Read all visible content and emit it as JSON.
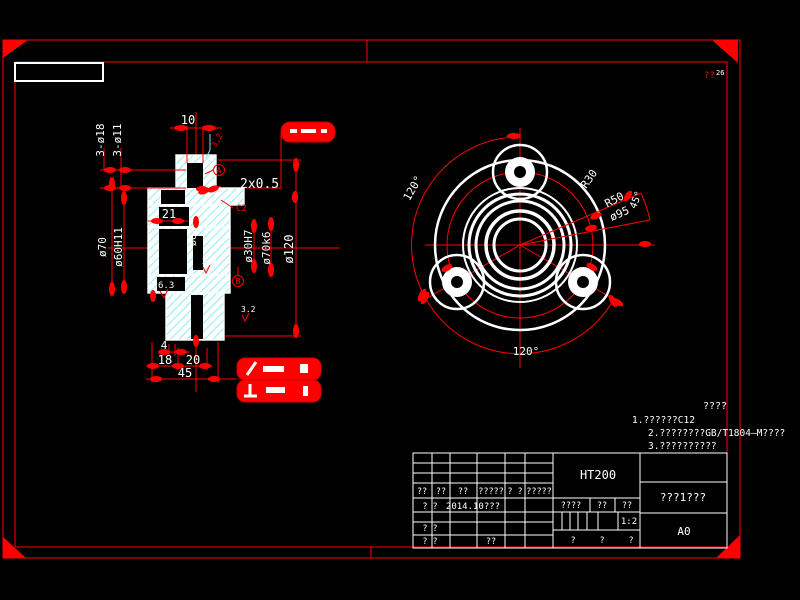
{
  "colors": {
    "bg": "#000000",
    "line": "#ffffff",
    "dim": "#ff0000",
    "hatch": "#7fe8e8"
  },
  "front_view": {
    "dims": {
      "d10": "10",
      "holes18": "3-ø18",
      "holes11": "3-ø11",
      "groove": "2x0.5",
      "c2": "C2",
      "d21": "21",
      "d70": "ø70",
      "d60": "ø60H11",
      "d62": "ø62",
      "d30": "ø30H7",
      "d70k6": "ø70k6",
      "d120": "ø120",
      "l4": "4",
      "l18": "18",
      "l20": "20",
      "l45": "45",
      "finish_top": "3.2",
      "finish_mid": "3.2",
      "finish_low": "3.2",
      "finish_63": "6.3",
      "datumA": "A",
      "datumB": "B"
    }
  },
  "side_view": {
    "dims": {
      "a120top": "120°",
      "a120bot": "120°",
      "r30": "R30",
      "r50": "R50",
      "d95": "ø95",
      "a45": "45°"
    }
  },
  "notes": {
    "title": "????",
    "item1": "1.??????C12",
    "item2": "2.????????GB/T1804—M????",
    "item3": "3.??????????"
  },
  "corner_note": {
    "left": "??",
    "right": "26"
  },
  "title_block": {
    "material": "HT200",
    "part_name": "???1???",
    "sheet_size": "A0",
    "scale": "1:2",
    "col_headers": {
      "c1": "??",
      "c2": "??",
      "c3": "??",
      "c4": "?????",
      "c5": "? ?",
      "c6": "?????"
    },
    "row_design": {
      "label": "? ?",
      "date": "2014.10???"
    },
    "row_proof": {
      "label": "? ?"
    },
    "row_approve": {
      "label": "? ?",
      "extra": "??"
    },
    "stage": {
      "h1": "????",
      "h2": "??",
      "h3": "??"
    },
    "sheets": {
      "s1": "?",
      "s2": "?",
      "s3": "?"
    }
  }
}
